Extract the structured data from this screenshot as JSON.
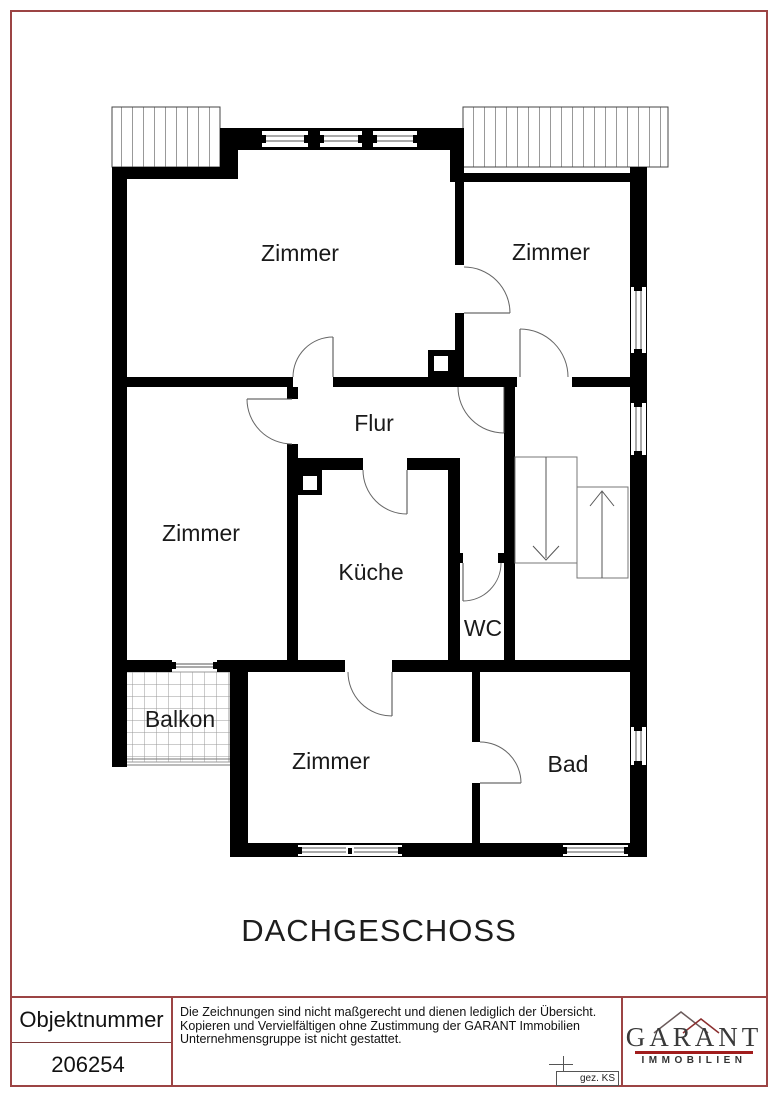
{
  "floor_plan": {
    "title": "DACHGESCHOSS",
    "rooms": {
      "zimmer_top_left": "Zimmer",
      "zimmer_top_right": "Zimmer",
      "zimmer_left": "Zimmer",
      "flur": "Flur",
      "kueche": "Küche",
      "wc": "WC",
      "balkon": "Balkon",
      "zimmer_bottom": "Zimmer",
      "bad": "Bad"
    }
  },
  "footer": {
    "object_number_label": "Objektnummer",
    "object_number": "206254",
    "disclaimer_lines": [
      "Die Zeichnungen sind nicht maßgerecht und dienen lediglich der Übersicht.",
      "Kopieren und Vervielfältigen ohne Zustimmung der GARANT Immobilien",
      "Unternehmensgruppe ist nicht gestattet."
    ],
    "drawn_by": "gez. KS"
  },
  "logo": {
    "name": "GARANT",
    "subtitle": "IMMOBILIEN",
    "accent_color": "#a11d1d",
    "roof_color": "#8b2e2e"
  },
  "colors": {
    "wall": "#000000",
    "border_red": "#9c4444"
  }
}
